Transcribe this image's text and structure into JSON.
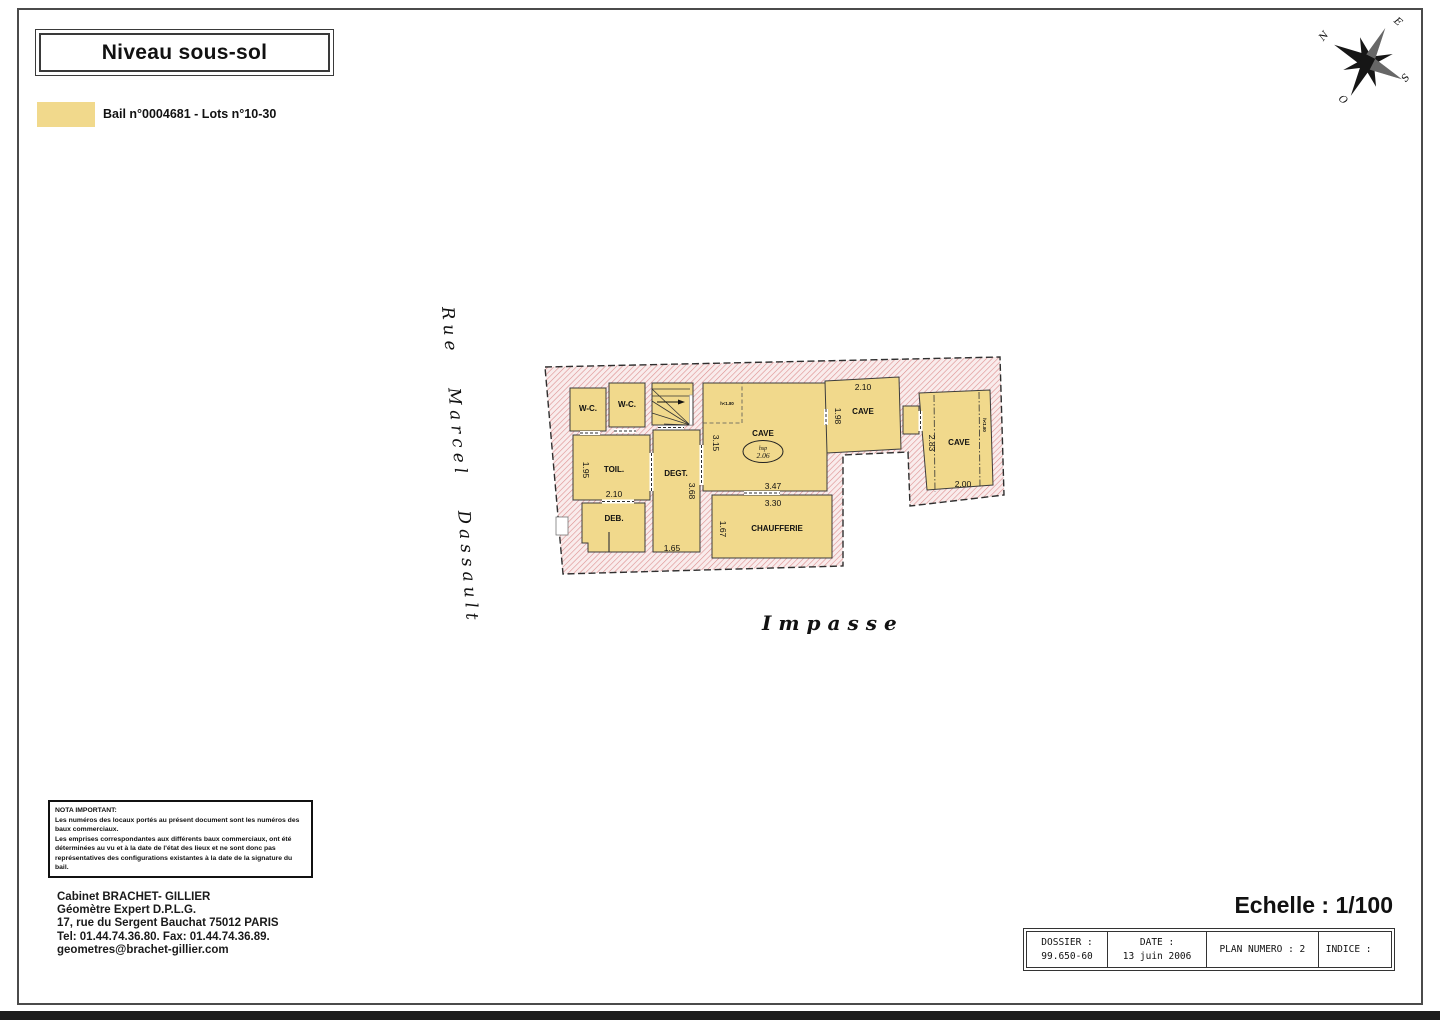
{
  "title": "Niveau sous-sol",
  "legend": {
    "label": "Bail n°0004681 - Lots n°10-30",
    "swatch_color": "#F1D98C"
  },
  "colors": {
    "room_fill": "#F1D98C",
    "hatch_line": "#DD8F8F"
  },
  "compass": {
    "n": "N",
    "e": "E",
    "s": "S",
    "o": "O"
  },
  "streets": {
    "left": "Rue Marcel Dassault",
    "bottom": "Impasse"
  },
  "plan": {
    "rooms": {
      "wc1": "W-C.",
      "wc2": "W-C.",
      "toil": "TOIL.",
      "deb": "DEB.",
      "degt": "DEGT.",
      "cave": "CAVE",
      "chaufferie": "CHAUFFERIE",
      "cave2": "CAVE",
      "cave3": "CAVE"
    },
    "annotations": {
      "hsp_label": "hsp",
      "hsp_value": "2.06",
      "h180_cave": "h<1.80",
      "h180_cave3": "h<1.80"
    },
    "dims": {
      "d195": "1.95",
      "d210": "2.10",
      "d368": "3.68",
      "d165": "1.65",
      "d167": "1.67",
      "d315": "3.15",
      "d347": "3.47",
      "d330": "3.30",
      "d210b": "2.10",
      "d198": "1.98",
      "d283": "2.83",
      "d200": "2.00"
    }
  },
  "nota": {
    "title": "NOTA IMPORTANT:",
    "lines": [
      "Les numéros des locaux portés au présent document sont les numéros des",
      "baux commerciaux.",
      "Les emprises correspondantes aux différents baux commerciaux, ont été",
      "déterminées au vu et à la date de l'état des lieux et ne sont donc pas",
      "représentatives des configurations existantes à la date de la signature du bail."
    ]
  },
  "firm": {
    "lines": [
      "Cabinet BRACHET- GILLIER",
      "Géomètre Expert D.P.L.G.",
      "17, rue du Sergent Bauchat 75012 PARIS",
      "Tel: 01.44.74.36.80. Fax: 01.44.74.36.89.",
      "geometres@brachet-gillier.com"
    ]
  },
  "scale_label": "Echelle : 1/100",
  "titleblock": {
    "dossier_label": "DOSSIER :",
    "dossier_value": "99.650-60",
    "date_label": "DATE :",
    "date_value": "13 juin 2006",
    "plan_label": "PLAN NUMERO : 2",
    "indice_label": "INDICE :"
  }
}
